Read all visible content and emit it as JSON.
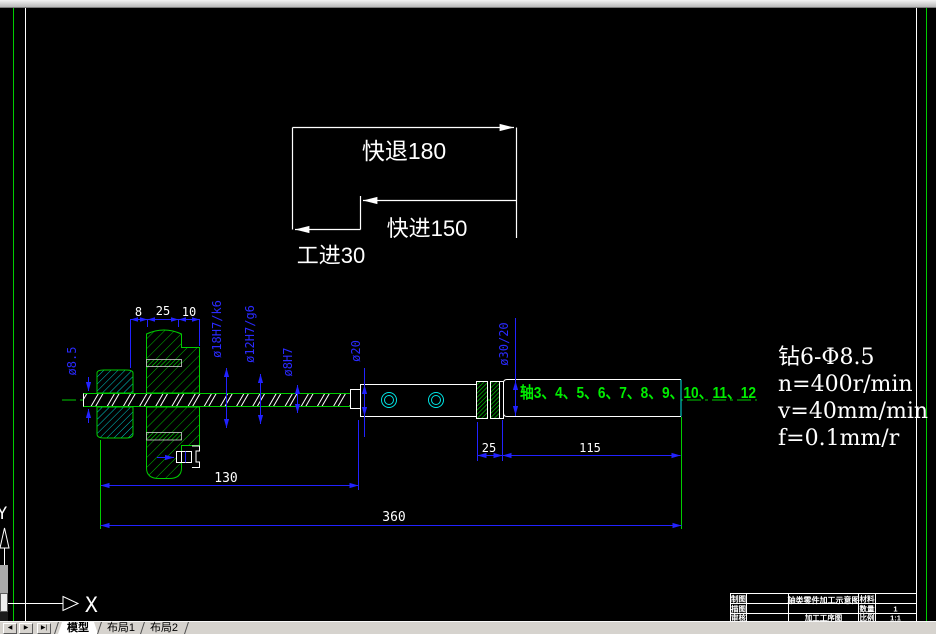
{
  "cycle": {
    "rapid_retract": "快退180",
    "rapid_advance": "快进150",
    "work_feed": "工进30"
  },
  "dimensions": {
    "seg8": "8",
    "seg25": "25",
    "seg10": "10",
    "dia18": "ø18H7/k6",
    "dia12": "ø12H7/g6",
    "dia8h7": "ø8H7",
    "dia85": "ø8.5",
    "dia20": "ø20",
    "dia3020": "ø30/20",
    "len25": "25",
    "len115": "115",
    "len130": "130",
    "len360": "360"
  },
  "shaft_label": "轴3、4、5、6、7、8、9、10、11、12",
  "specs": {
    "line1": "钻6-Φ8.5",
    "line2": "n=400r/min",
    "line3": "v=40mm/min",
    "line4": "f=0.1mm/r"
  },
  "ucs": {
    "x": "X",
    "y": "Y"
  },
  "title_block": {
    "row1_label": "制图",
    "row2_label": "描图",
    "row3_label": "审核",
    "title": "轴类零件加工示意图",
    "subtitle": "加工工序图",
    "material_label": "材料",
    "qty_label": "数量",
    "scale_label": "比例",
    "qty_value": "1",
    "scale_value": "1:1"
  },
  "tabbar": {
    "nav_first": "◀",
    "nav_prev": "▶",
    "nav_next": "▶|",
    "tabs": [
      {
        "label": "模型"
      },
      {
        "label": "布局1"
      },
      {
        "label": "布局2"
      }
    ]
  },
  "colors": {
    "dimension_blue": "#2222ff",
    "line_green": "#00cc00",
    "hole_cyan": "#00e5e5",
    "label_green": "#00ee00",
    "linework_white": "#ffffff"
  }
}
